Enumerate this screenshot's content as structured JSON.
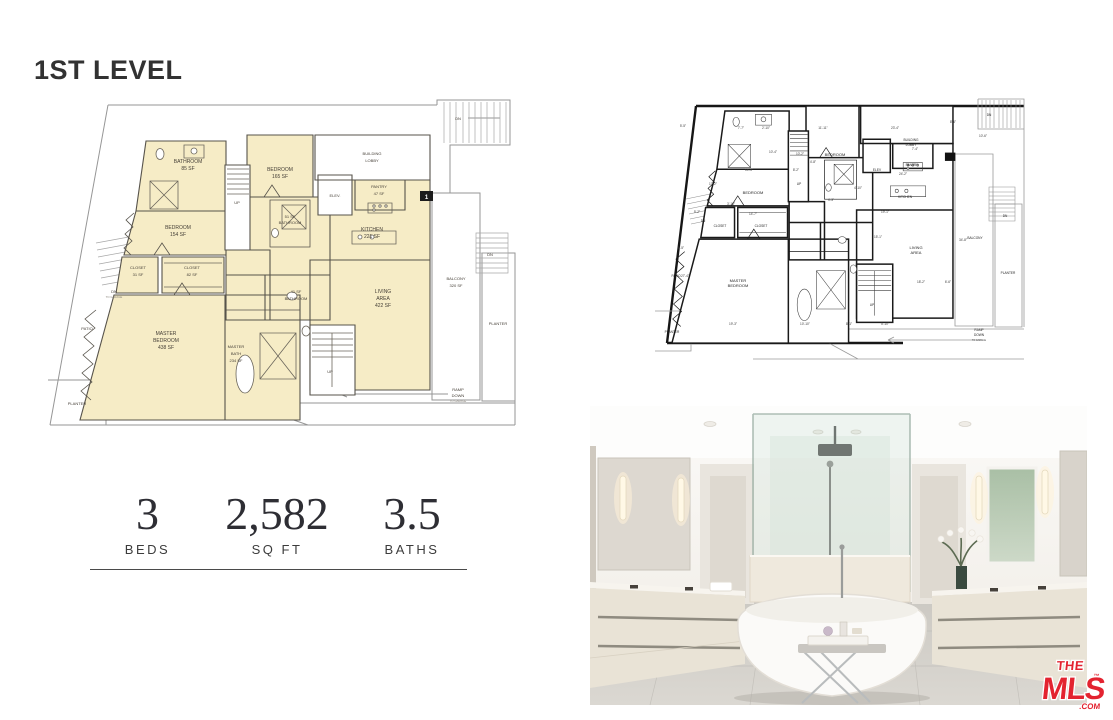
{
  "page": {
    "title": "1ST LEVEL"
  },
  "stats": {
    "items": [
      {
        "value": "3",
        "label": "BEDS"
      },
      {
        "value": "2,582",
        "label": "SQ FT"
      },
      {
        "value": "3.5",
        "label": "BATHS"
      }
    ]
  },
  "colors": {
    "room_fill": "#f6ecc6",
    "wall": "#57534b",
    "boundary": "#969696",
    "tech_wall": "#1a1a1a",
    "logo_red": "#e32330",
    "title_color": "#323232"
  },
  "plan_main": {
    "rooms": {
      "bathroom_top": {
        "name": "BATHROOM",
        "area": "85 SF"
      },
      "bedroom_right": {
        "name": "BEDROOM",
        "area": "165 SF"
      },
      "bedroom_left": {
        "name": "BEDROOM",
        "area": "154 SF"
      },
      "bathroom_51": {
        "area": "51 SF",
        "name": "BATHROOM"
      },
      "closet_31": {
        "name": "CLOSET",
        "area": "31 SF"
      },
      "closet_82": {
        "name": "CLOSET",
        "area": "82 SF"
      },
      "master_bedroom": {
        "l1": "MASTER",
        "l2": "BEDROOM",
        "area": "438 SF"
      },
      "master_bath": {
        "l1": "MASTER",
        "l2": "BATH",
        "area": "234 SF"
      },
      "bathroom_41": {
        "area": "41 SF",
        "name": "BATHROOM"
      },
      "lobby": {
        "l1": "BUILDING",
        "l2": "LOBBY"
      },
      "elev": {
        "name": "ELEV."
      },
      "pantry": {
        "name": "PANTRY",
        "area": "47 SF"
      },
      "kitchen": {
        "name": "KITCHEN",
        "area": "221 SF"
      },
      "living": {
        "l1": "LIVING",
        "l2": "AREA",
        "area": "422 SF"
      },
      "balcony": {
        "name": "BALCONY",
        "area": "320 SF"
      },
      "planter_right": {
        "name": "PLANTER"
      },
      "planter_bottom": {
        "name": "PLANTER"
      },
      "patio": {
        "name": "PATIO"
      },
      "ramp": {
        "l1": "RAMP",
        "l2": "DOWN",
        "note": "TO GARAGE"
      }
    },
    "markers": {
      "up": "UP",
      "dn": "DN",
      "entry": "1"
    }
  },
  "plan_tech": {
    "labels": {
      "bedroom": "BEDROOM",
      "closet": "CLOSET",
      "master1": "MASTER",
      "master2": "BEDROOM",
      "patio": "PATIO",
      "planter": "PLANTER",
      "elev": "ELEV",
      "pantry": "PANTRY",
      "lobby1": "BUILDING",
      "lobby2": "LOBBY",
      "kitchen": "KITCHEN",
      "living1": "LIVING",
      "living2": "AREA",
      "balcony": "BALCONY",
      "ramp1": "RAMP",
      "ramp2": "DOWN",
      "up": "UP",
      "dn": "DN"
    },
    "dimensions": [
      {
        "x": 30,
        "y": 34,
        "t": "5'-5\""
      },
      {
        "x": 88,
        "y": 36,
        "t": "7'-7\""
      },
      {
        "x": 113,
        "y": 36,
        "t": "2'-10\""
      },
      {
        "x": 170,
        "y": 36,
        "t": "11'-11\""
      },
      {
        "x": 242,
        "y": 36,
        "t": "23'-4\""
      },
      {
        "x": 300,
        "y": 30,
        "t": "8'-6\""
      },
      {
        "x": 330,
        "y": 44,
        "t": "10'-6\""
      },
      {
        "x": 262,
        "y": 57,
        "t": "7'-4\""
      },
      {
        "x": 250,
        "y": 82,
        "t": "24'-2\""
      },
      {
        "x": 120,
        "y": 60,
        "t": "10'-4\""
      },
      {
        "x": 147,
        "y": 62,
        "t": "10'-2\""
      },
      {
        "x": 96,
        "y": 78,
        "t": "14'-5\""
      },
      {
        "x": 143,
        "y": 78,
        "t": "8'-2\""
      },
      {
        "x": 160,
        "y": 70,
        "t": "4'-8\""
      },
      {
        "x": 60,
        "y": 92,
        "t": "17'-2\""
      },
      {
        "x": 44,
        "y": 120,
        "t": "5'-2\""
      },
      {
        "x": 100,
        "y": 122,
        "t": "14'-7\""
      },
      {
        "x": 78,
        "y": 112,
        "t": "3'-10\""
      },
      {
        "x": 28,
        "y": 156,
        "t": "8'-5\""
      },
      {
        "x": 32,
        "y": 184,
        "t": "27'-4\""
      },
      {
        "x": 80,
        "y": 232,
        "t": "19'-3\""
      },
      {
        "x": 152,
        "y": 232,
        "t": "10'-10\""
      },
      {
        "x": 196,
        "y": 232,
        "t": "8'-1\""
      },
      {
        "x": 232,
        "y": 232,
        "t": "5'-10\""
      },
      {
        "x": 310,
        "y": 148,
        "t": "34'-8\""
      },
      {
        "x": 232,
        "y": 120,
        "t": "19'-1\""
      },
      {
        "x": 268,
        "y": 190,
        "t": "18'-2\""
      },
      {
        "x": 295,
        "y": 190,
        "t": "6'-6\""
      },
      {
        "x": 178,
        "y": 108,
        "t": "4'-3\""
      },
      {
        "x": 205,
        "y": 96,
        "t": "4'-10\""
      },
      {
        "x": 225,
        "y": 145,
        "t": "15'-1\""
      }
    ]
  },
  "logo": {
    "the": "THE",
    "mls": "MLS",
    "com": ".COM",
    "tm": "™"
  }
}
